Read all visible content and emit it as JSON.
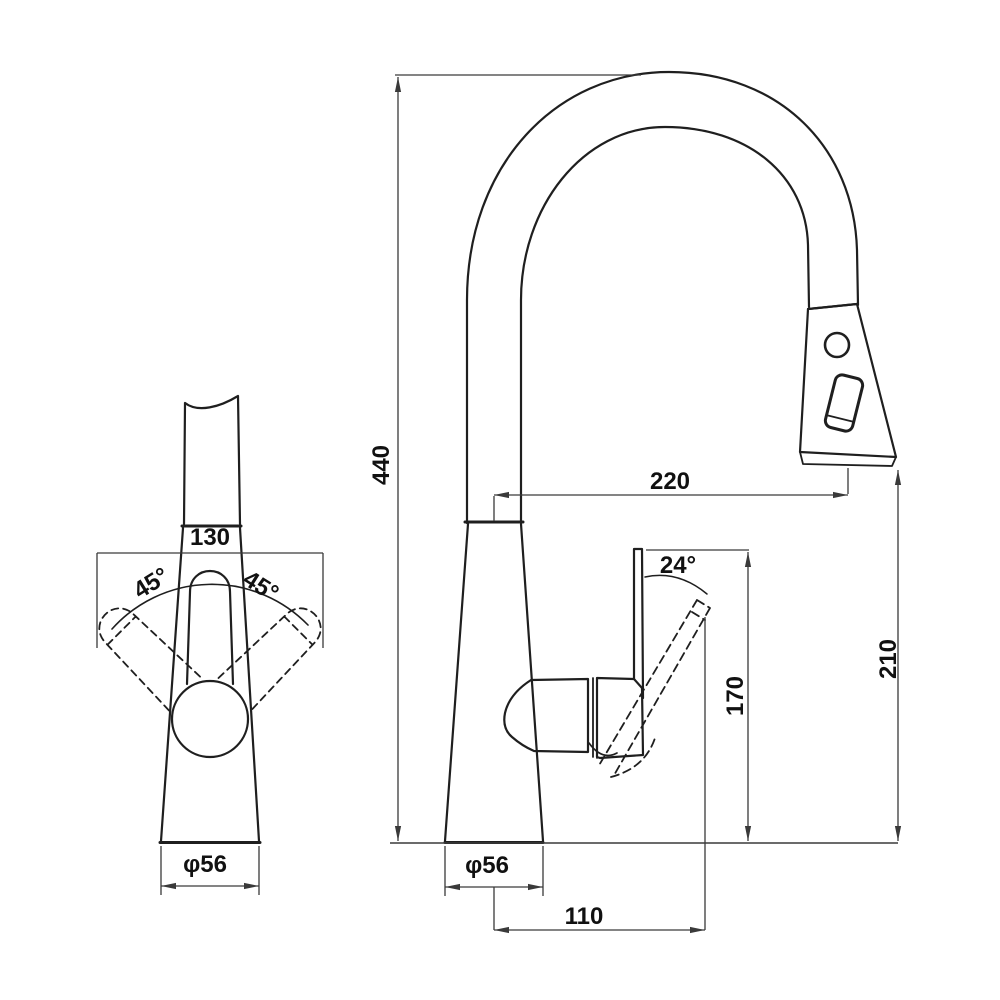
{
  "drawing": {
    "kind": "faucet-dimension-drawing",
    "colors": {
      "background": "#ffffff",
      "outline": "#1f1f1f",
      "dimension_lines": "#3a3a3a",
      "text": "#111111"
    },
    "labels": {
      "front_view": {
        "width": "130",
        "swing_left": "45°",
        "swing_right": "45°",
        "base_diameter": "φ56"
      },
      "side_view": {
        "height": "440",
        "spout_reach": "220",
        "handle_angle": "24°",
        "handle_height": "170",
        "spout_height": "210",
        "base_diameter": "φ56",
        "handle_reach": "110"
      }
    }
  }
}
